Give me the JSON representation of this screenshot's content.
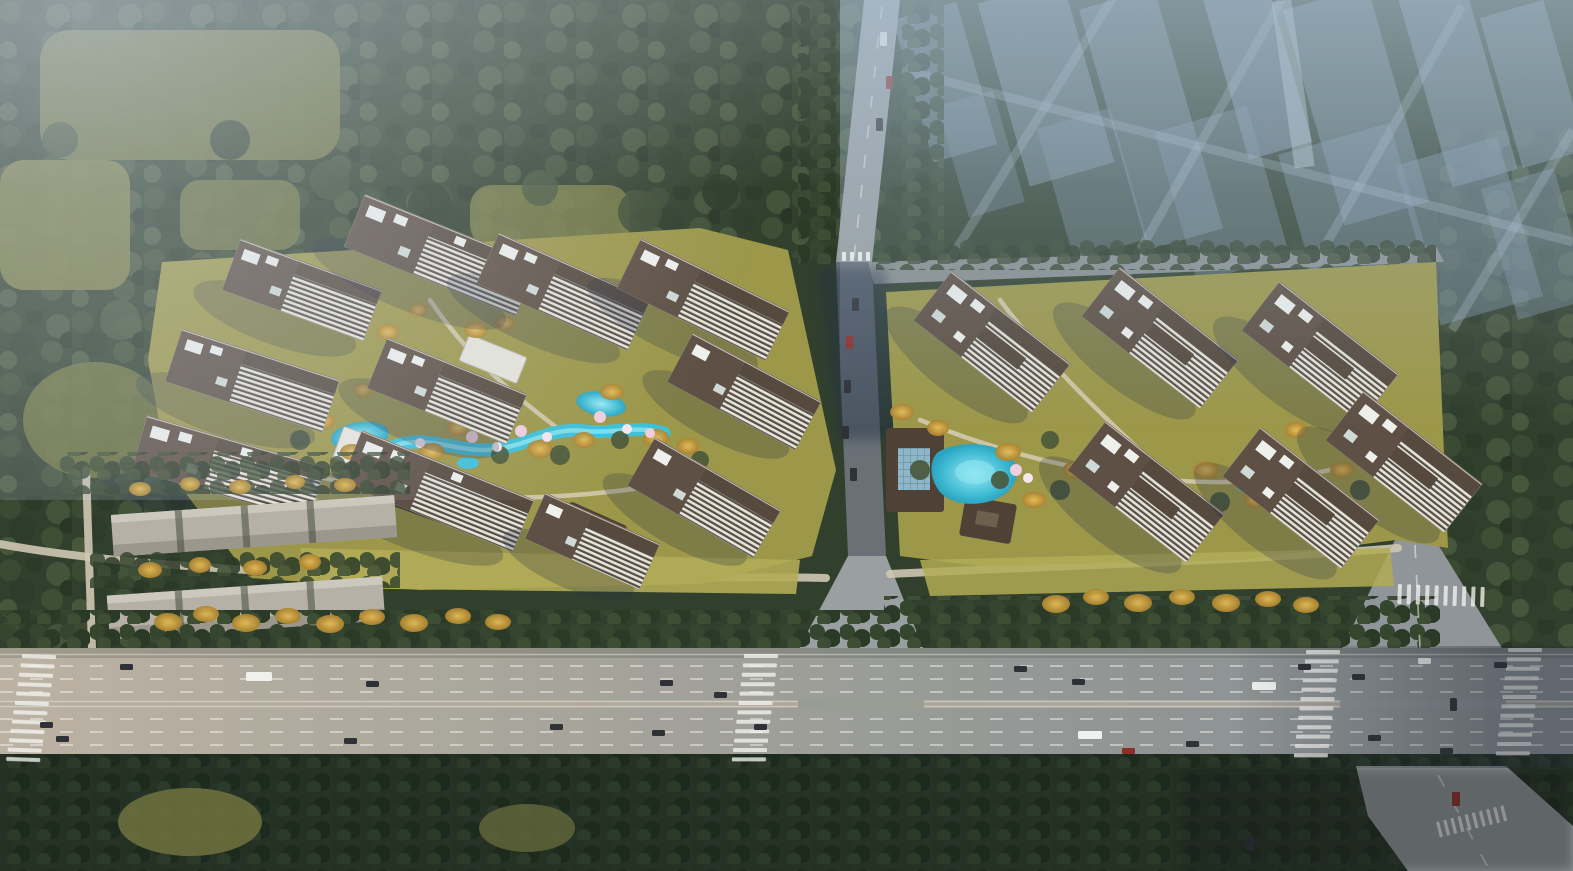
{
  "scene": {
    "title": "Aerial rendering of a new residential development beside an arterial highway",
    "description": "Bird's-eye architectural rendering. Two residential compounds of cream slab high-rise towers with dark brown roofs surround landscaped water gardens with cyan pools, golden and blossom trees. A tree-lined avenue runs between the compounds from the top of the image. A long row-building block sits to the southwest. A wide multi-lane highway with lane dashes, crosswalks, vehicles and a large signalized intersection crosses the bottom. Dense forest belts and olive farmland clearings fill the left, and a hazy fog-faded city skyline of tall blocks occupies the upper right.",
    "areas": [
      {
        "id": "farmland-clearings",
        "label": "Olive farmland clearings in forest (upper left)"
      },
      {
        "id": "ghost-skyline",
        "label": "Fog-faded existing city skyline (upper right)"
      },
      {
        "id": "north-avenue",
        "label": "Tree-lined avenue between compounds"
      },
      {
        "id": "left-compound",
        "label": "West residential compound with winding water garden"
      },
      {
        "id": "right-compound",
        "label": "East residential compound with clubhouse pool"
      },
      {
        "id": "industrial-rows",
        "label": "Existing long row buildings (southwest)"
      },
      {
        "id": "arterial-highway",
        "label": "Multi-lane arterial highway (bottom)"
      },
      {
        "id": "intersection",
        "label": "Signalized intersection with crosswalks (bottom right)"
      },
      {
        "id": "south-forest",
        "label": "Dense forest belt along bottom edge"
      }
    ],
    "inventory": {
      "towers_west_compound": 11,
      "towers_east_compound": 6,
      "ponds_and_pools": 6,
      "vehicles_visible": 34,
      "crosswalks": 7,
      "row_buildings": 2
    }
  },
  "palette": {
    "forest_base": "#31402d",
    "forest_dark": "#273226",
    "field_olive": "#6f7440",
    "field_light": "#7d7f46",
    "lawn": "#9c9749",
    "lawn_bright": "#b2ab56",
    "golden_tree": "#cf9f3c",
    "shrub_green": "#49573a",
    "road_grey": "#9aa0a2",
    "road_minor": "#8f9598",
    "road_shadowed": "#6a7076",
    "highway_warm": "#bcb2a3",
    "highway_cool": "#878d90",
    "marking_white": "#f4f4f0",
    "path_light": "#d6cdb4",
    "facade_cream": "#eae4d5",
    "window_dark": "#524e4c",
    "roof_brown": "#5e5045",
    "roof_dark": "#4f4136",
    "roof_white": "#eef0ec",
    "pool_cyan": "#3cc0d8",
    "pool_light": "#8ce4ef",
    "glass_blue": "#8fb6c8",
    "blossom_pink": "#eecfdd",
    "industrial_roof": "#b5b1a6",
    "ghost_block": "#7f93a6",
    "fog_blue": "#adc1d4",
    "haze_blue": "#c8d8e6",
    "shadow_navy": "#223047",
    "car_dark": "#2e3136",
    "car_white": "#f0f1ee",
    "car_red": "#8c2f28"
  }
}
